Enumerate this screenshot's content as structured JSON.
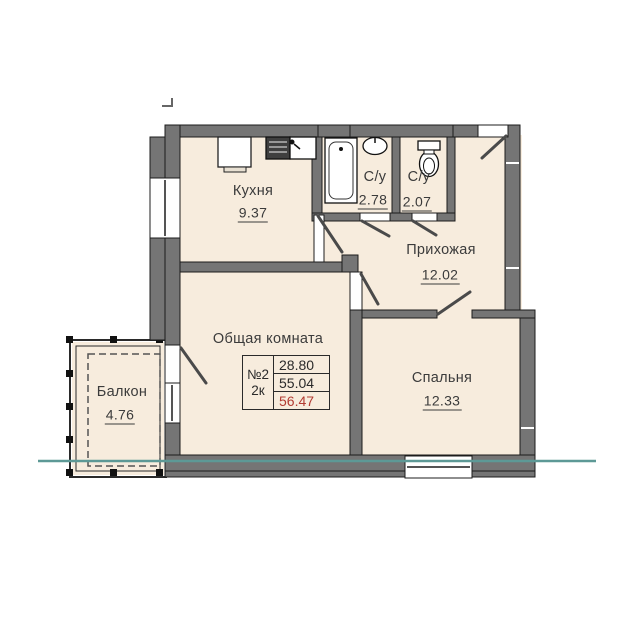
{
  "rooms": {
    "kitchen": {
      "name": "Кухня",
      "area": "9.37"
    },
    "bathroom": {
      "name": "С/у",
      "area": "2.78"
    },
    "wc": {
      "name": "С/у",
      "area": "2.07"
    },
    "hallway": {
      "name": "Прихожая",
      "area": "12.02"
    },
    "living_room": {
      "name": "Общая комната"
    },
    "bedroom": {
      "name": "Спальня",
      "area": "12.33"
    },
    "balcony": {
      "name": "Балкон",
      "area": "4.76"
    }
  },
  "apartment_info": {
    "number": "№2",
    "rooms_count": "2к",
    "living_area": "28.80",
    "apartment_area": "55.04",
    "total_area": "56.47"
  },
  "colors": {
    "wall_gray": "#757575",
    "floor_cream": "#f7ecdd",
    "section_line_teal": "#5d9996",
    "total_area_red": "#b23b32",
    "text_dark": "#3b3b3b"
  }
}
